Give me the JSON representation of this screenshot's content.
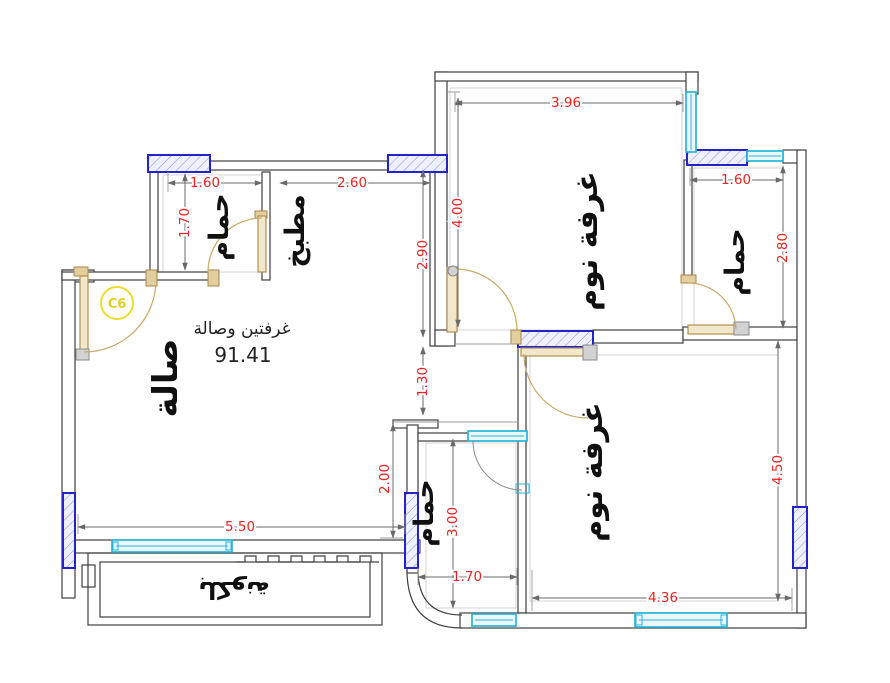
{
  "rooms": {
    "hall": "صالة",
    "kitchen": "مطبخ",
    "bathroom_top_left": "حمام",
    "bathroom_top_right": "حمام",
    "bathroom_bottom": "حمام",
    "bedroom_top": "غرفة نوم",
    "bedroom_bottom": "غرفة نوم",
    "balcony": "بلكونة"
  },
  "annotations": {
    "summary": "غرفتين وصالة",
    "total_area": "91.41",
    "column_tag": "C6"
  },
  "dimensions": {
    "bedroom_top_width": "3.96",
    "bedroom_top_height": "4.00",
    "kitchen_height": "2.90",
    "kitchen_width": "2.60",
    "bathroom_top_left_width": "1.60",
    "bathroom_top_left_height": "1.70",
    "bathroom_top_right_width": "1.60",
    "bathroom_top_right_height": "2.80",
    "hall_opening": "1.30",
    "hall_right_height": "2.00",
    "hall_width": "5.50",
    "bathroom_bottom_height": "3.00",
    "bathroom_bottom_width": "1.70",
    "bedroom_bottom_width": "4.36",
    "bedroom_bottom_height": "4.50"
  },
  "colors": {
    "dimension_text": "#ee2222",
    "wall_line": "#404040",
    "column_border": "#2323c8",
    "column_fill": "#eef0fb",
    "window": "#2ab4d6",
    "door": "#c2a26a",
    "column_tag": "#e3cf20",
    "label_text": "#101010"
  }
}
